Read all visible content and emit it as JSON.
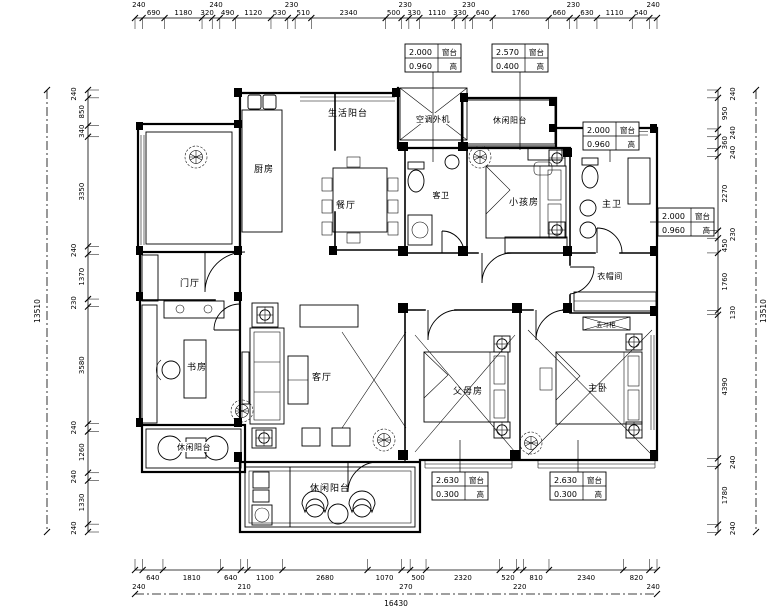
{
  "colors": {
    "line": "#000000",
    "bg": "#ffffff"
  },
  "rooms": {
    "service_balcony": {
      "label": "生活阳台"
    },
    "kitchen": {
      "label": "厨房"
    },
    "dining": {
      "label": "餐厅"
    },
    "ac_unit": {
      "label": "空调外机"
    },
    "top_balcony": {
      "label": "休闲阳台"
    },
    "guest_bath": {
      "label": "客卫"
    },
    "kids_room": {
      "label": "小孩房"
    },
    "master_bath": {
      "label": "主卫"
    },
    "cloakroom": {
      "label": "衣帽间"
    },
    "foyer": {
      "label": "门厅"
    },
    "study": {
      "label": "书房"
    },
    "living": {
      "label": "客厅"
    },
    "parents_room": {
      "label": "父母房"
    },
    "master_bedroom": {
      "label": "主卧"
    },
    "left_balcony": {
      "label": "休闲阳台"
    },
    "bottom_balcony": {
      "label": "休闲阳台"
    },
    "chest": {
      "label": "五斗柜"
    }
  },
  "annotations": {
    "sill_label": "窗台",
    "height_label": "高",
    "boxes": [
      {
        "id": "top1",
        "top": "2.000",
        "bottom": "0.960"
      },
      {
        "id": "top2",
        "top": "2.570",
        "bottom": "0.400"
      },
      {
        "id": "right1",
        "top": "2.000",
        "bottom": "0.960"
      },
      {
        "id": "right2",
        "top": "2.000",
        "bottom": "0.960"
      },
      {
        "id": "bottom1",
        "top": "2.630",
        "bottom": "0.300"
      },
      {
        "id": "bottom2",
        "top": "2.630",
        "bottom": "0.300"
      }
    ]
  },
  "dimensions": {
    "top": [
      "240",
      "690",
      "1180",
      "320",
      "240",
      "490",
      "1120",
      "530",
      "230",
      "510",
      "2340",
      "500",
      "230",
      "330",
      "1110",
      "330",
      "230",
      "640",
      "1760",
      "660",
      "230",
      "630",
      "1110",
      "540",
      "240"
    ],
    "bottom": [
      "240",
      "640",
      "1810",
      "640",
      "210",
      "1100",
      "2680",
      "1070",
      "270",
      "500",
      "2320",
      "520",
      "220",
      "810",
      "2340",
      "820",
      "240"
    ],
    "left": [
      "240",
      "850",
      "340",
      "3350",
      "240",
      "1370",
      "230",
      "3580",
      "240",
      "1260",
      "240",
      "1330",
      "240"
    ],
    "right": [
      "240",
      "950",
      "240",
      "360",
      "240",
      "2270",
      "230",
      "450",
      "1760",
      "130",
      "4390",
      "240",
      "1780",
      "240"
    ],
    "total_width": "16430",
    "total_height": "13510"
  }
}
